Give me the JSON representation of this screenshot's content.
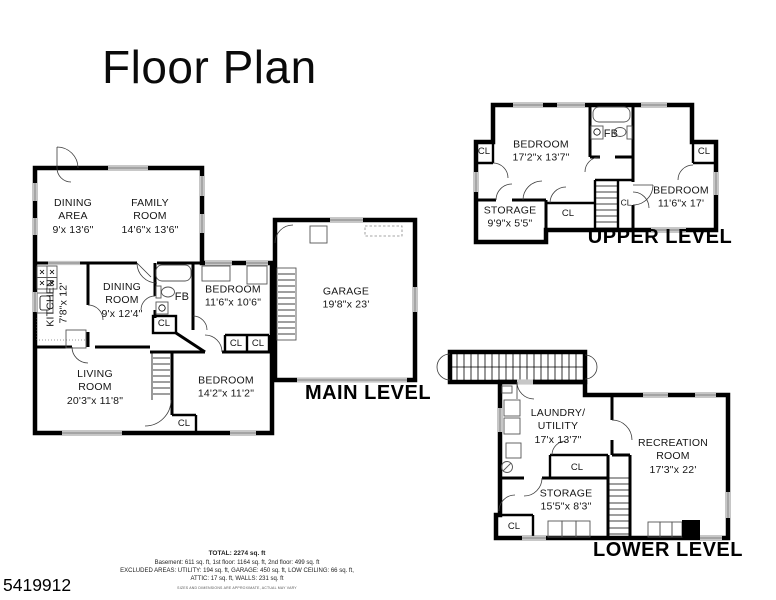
{
  "title": "Floor Plan",
  "listing_id": "5419912",
  "closet_label": "CL",
  "levels": {
    "main": {
      "name": "MAIN LEVEL",
      "rooms": {
        "dining_area": "DINING\nAREA\n9'x 13'6\"",
        "family_room": "FAMILY\nROOM\n14'6\"x 13'6\"",
        "kitchen": "KITCHEN\n7'8\"x 12'",
        "dining_room": "DINING\nROOM\n9'x 12'4\"",
        "bath": "FB",
        "bedroom_middle": "BEDROOM\n11'6\"x 10'6\"",
        "garage": "GARAGE\n19'8\"x 23'",
        "living_room": "LIVING\nROOM\n20'3\"x 11'8\"",
        "bedroom_lower": "BEDROOM\n14'2\"x 11'2\""
      }
    },
    "upper": {
      "name": "UPPER LEVEL",
      "rooms": {
        "bedroom_left": "BEDROOM\n17'2\"x 13'7\"",
        "bedroom_right": "BEDROOM\n11'6\"x 17'",
        "storage": "STORAGE\n9'9\"x 5'5\"",
        "bath": "FB"
      }
    },
    "lower": {
      "name": "LOWER LEVEL",
      "rooms": {
        "laundry": "LAUNDRY/\nUTILITY\n17'x 13'7\"",
        "recreation": "RECREATION\nROOM\n17'3\"x 22'",
        "storage": "STORAGE\n15'5\"x 8'3\""
      }
    }
  },
  "summary": {
    "total": "TOTAL: 2274 sq. ft",
    "floors": "Basement: 611 sq. ft, 1st floor: 1164 sq. ft, 2nd floor: 499 sq. ft",
    "excluded1": "EXCLUDED AREAS: UTILITY: 194 sq. ft, GARAGE: 450 sq. ft, LOW CEILING: 66 sq. ft,",
    "excluded2": "ATTIC: 17 sq. ft, WALLS: 231 sq. ft",
    "disclaimer": "SIZES AND DIMENSIONS ARE APPROXIMATE, ACTUAL MAY VARY"
  },
  "colors": {
    "wall": "#000000",
    "window": "#c7c7c7",
    "text": "#151515"
  }
}
